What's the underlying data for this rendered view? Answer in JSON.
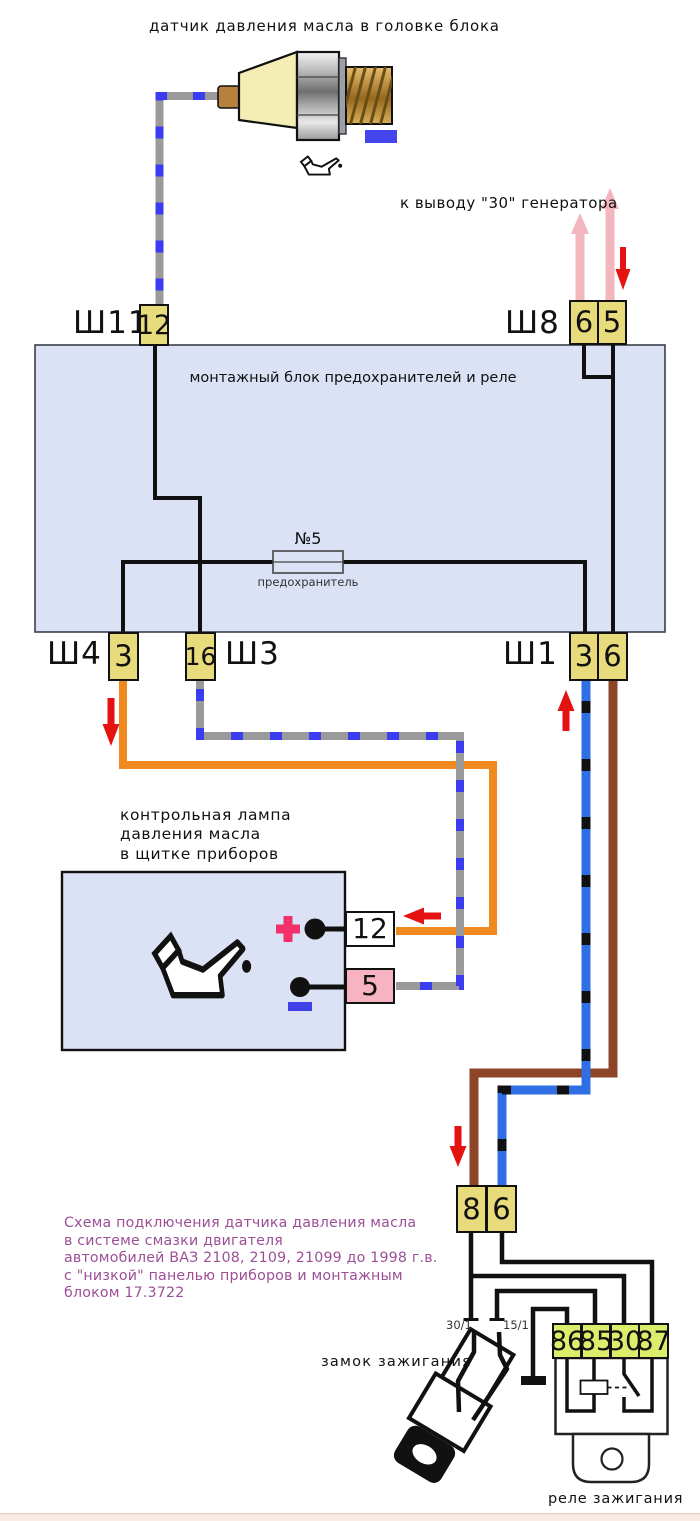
{
  "title": "датчик давления масла в головке блока",
  "generator_label": "к выводу \"30\" генератора",
  "block": {
    "title": "монтажный блок предохранителей и реле",
    "fuse_name": "№5",
    "fuse_caption": "предохранитель"
  },
  "connectors": {
    "sh11": {
      "name": "Ш11",
      "pin": "12"
    },
    "sh8": {
      "name": "Ш8",
      "pin_left": "6",
      "pin_right": "5"
    },
    "sh4": {
      "name": "Ш4",
      "pin": "3"
    },
    "sh3": {
      "name": "Ш3",
      "pin": "16"
    },
    "sh1": {
      "name": "Ш1",
      "pin_left": "3",
      "pin_right": "6"
    },
    "harness": {
      "pin_left": "8",
      "pin_right": "6"
    }
  },
  "lamp": {
    "line1": "контрольная лампа",
    "line2": "давления масла",
    "line3": "в щитке приборов",
    "plus_pin": "12",
    "minus_pin": "5",
    "polarity_plus": "+",
    "polarity_minus": "−"
  },
  "caption": {
    "line1": "Схема подключения датчика давления масла",
    "line2": "в системе смазки двигателя",
    "line3": "автомобилей ВАЗ 2108, 2109, 21099 до 1998 г.в.",
    "line4": "с \"низкой\" панелью приборов и монтажным",
    "line5": "блоком 17.3722"
  },
  "ignition_lock": {
    "label": "замок зажигания",
    "terminal_left": "30/1",
    "terminal_right": "15/1"
  },
  "relay": {
    "label": "реле зажигания",
    "pin1": "86",
    "pin2": "85",
    "pin3": "30",
    "pin4": "87"
  },
  "colors": {
    "block_fill": "#dbe2f6",
    "pin_fill": "#e8db7c",
    "relay_pin_fill": "#dcec6b",
    "orange_wire": "#f08a1e",
    "brown_wire": "#8d4527",
    "blue_wire": "#2f6fe3",
    "blue_wire_dash": "#111111",
    "gray_wire": "#9a9a9a",
    "gray_wire_dash": "#3b3bf0",
    "red_arrow": "#e51212",
    "pink_arrow": "#f2b6bc",
    "minus_box_fill": "#f8b3c3",
    "plus_color": "#f23069",
    "minus_color": "#4040e8",
    "caption_color": "#9c4f96"
  }
}
